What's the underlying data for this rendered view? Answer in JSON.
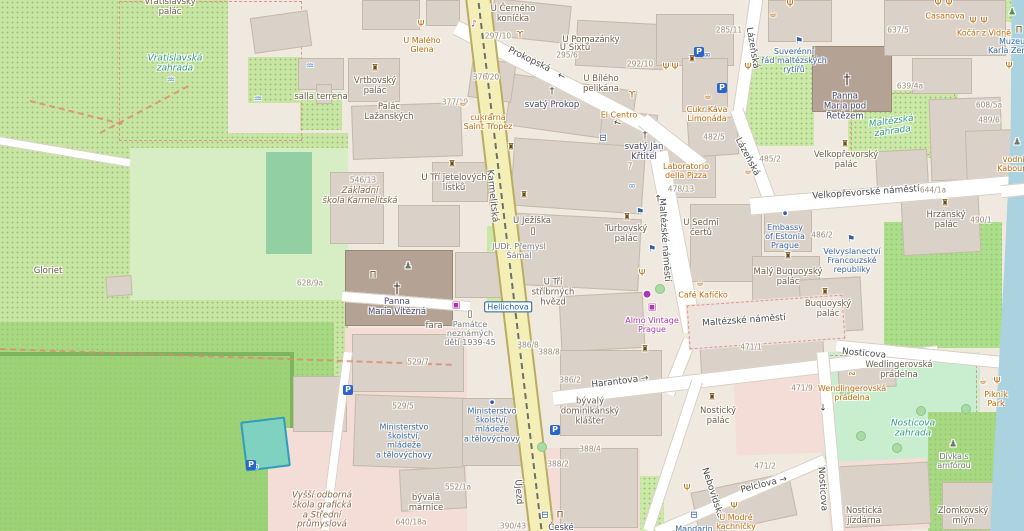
{
  "palette": {
    "road_main_yellow": "#f4efb7",
    "water_blue": "#aad3df",
    "park_green": "#c9e5a3",
    "bright_green": "#a6d980",
    "garden_green": "#cbe8a6",
    "mint_green": "#c8eecf",
    "building_gray": "#dad1c8",
    "church_brown": "#b4a294",
    "pink_area": "#f4dcd7",
    "pitch_teal": "#7fd2c0",
    "poi_orange": "#bf6c0a",
    "amenity_blue": "#3a68a0",
    "shop_purple": "#ac39ac",
    "church_label": "#464a6e",
    "garden_label": "#2f9e81",
    "street_label": "#4e4e4e",
    "house_number": "#9c8c79"
  },
  "labels": [
    {
      "t": "Prokopská",
      "x": 529,
      "y": 60,
      "k": "street",
      "r": 26
    },
    {
      "t": "Karmelitská",
      "x": 492,
      "y": 196,
      "k": "street",
      "r": 84
    },
    {
      "t": "Újezd",
      "x": 518,
      "y": 492,
      "k": "street",
      "r": 86
    },
    {
      "t": "Lázeňská",
      "x": 752,
      "y": 48,
      "k": "street",
      "r": 80
    },
    {
      "t": "Lázeňská",
      "x": 747,
      "y": 157,
      "k": "street",
      "r": 62
    },
    {
      "t": "Velkopřevorské náměstí",
      "x": 866,
      "y": 193,
      "k": "street",
      "r": -4
    },
    {
      "t": "Maltézské náměstí",
      "x": 664,
      "y": 240,
      "k": "street",
      "r": 86
    },
    {
      "t": "Maltézské náměstí",
      "x": 744,
      "y": 321,
      "k": "street",
      "r": -4
    },
    {
      "t": "Harantova →",
      "x": 620,
      "y": 382,
      "k": "street",
      "r": -7
    },
    {
      "t": "Nosticova",
      "x": 864,
      "y": 354,
      "k": "street",
      "r": 5
    },
    {
      "t": "Nosticova",
      "x": 822,
      "y": 489,
      "k": "street",
      "r": 86
    },
    {
      "t": "Pelclova →",
      "x": 764,
      "y": 485,
      "k": "street",
      "r": -14
    },
    {
      "t": "Nebovidská",
      "x": 712,
      "y": 493,
      "k": "street",
      "r": 72
    },
    {
      "t": "Hellichova",
      "x": 508,
      "y": 307,
      "k": "stop"
    },
    {
      "t": "546/13",
      "x": 363,
      "y": 181,
      "k": "house"
    },
    {
      "t": "628/9a",
      "x": 310,
      "y": 284,
      "k": "house"
    },
    {
      "t": "529/7",
      "x": 418,
      "y": 363,
      "k": "house"
    },
    {
      "t": "529/5",
      "x": 403,
      "y": 407,
      "k": "house"
    },
    {
      "t": "552/1a",
      "x": 458,
      "y": 488,
      "k": "house"
    },
    {
      "t": "640/18a",
      "x": 411,
      "y": 523,
      "k": "house"
    },
    {
      "t": "390/43",
      "x": 513,
      "y": 527,
      "k": "house"
    },
    {
      "t": "386/2",
      "x": 570,
      "y": 381,
      "k": "house"
    },
    {
      "t": "386/8",
      "x": 528,
      "y": 346,
      "k": "house"
    },
    {
      "t": "388/8",
      "x": 549,
      "y": 353,
      "k": "house"
    },
    {
      "t": "388/2",
      "x": 558,
      "y": 465,
      "k": "house"
    },
    {
      "t": "388/4",
      "x": 590,
      "y": 450,
      "k": "house"
    },
    {
      "t": "377/19",
      "x": 455,
      "y": 103,
      "k": "house"
    },
    {
      "t": "376/20",
      "x": 486,
      "y": 78,
      "k": "house"
    },
    {
      "t": "297/10",
      "x": 498,
      "y": 37,
      "k": "house"
    },
    {
      "t": "295/6",
      "x": 567,
      "y": 56,
      "k": "house"
    },
    {
      "t": "292/10",
      "x": 640,
      "y": 65,
      "k": "house"
    },
    {
      "t": "285/11",
      "x": 729,
      "y": 31,
      "k": "house"
    },
    {
      "t": "482/5",
      "x": 714,
      "y": 138,
      "k": "house"
    },
    {
      "t": "485/2",
      "x": 770,
      "y": 160,
      "k": "house"
    },
    {
      "t": "478/13",
      "x": 681,
      "y": 190,
      "k": "house"
    },
    {
      "t": "471/1",
      "x": 751,
      "y": 348,
      "k": "house"
    },
    {
      "t": "471/9",
      "x": 802,
      "y": 389,
      "k": "house"
    },
    {
      "t": "471/2",
      "x": 765,
      "y": 467,
      "k": "house"
    },
    {
      "t": "486/2",
      "x": 822,
      "y": 236,
      "k": "house"
    },
    {
      "t": "490/1",
      "x": 981,
      "y": 221,
      "k": "house"
    },
    {
      "t": "644/1a",
      "x": 933,
      "y": 191,
      "k": "house"
    },
    {
      "t": "637/5",
      "x": 898,
      "y": 31,
      "k": "house"
    },
    {
      "t": "639/4a",
      "x": 910,
      "y": 87,
      "k": "house"
    },
    {
      "t": "608/5a",
      "x": 989,
      "y": 106,
      "k": "house"
    },
    {
      "t": "489/6",
      "x": 989,
      "y": 121,
      "k": "house"
    },
    {
      "t": "7",
      "x": 630,
      "y": 167,
      "k": "house"
    },
    {
      "t": "U Malého\nGlena",
      "x": 422,
      "y": 45,
      "k": "poi"
    },
    {
      "t": "cukrárna\nSaint Tropez",
      "x": 488,
      "y": 122,
      "k": "poi"
    },
    {
      "t": "El Centro",
      "x": 619,
      "y": 115,
      "k": "poi"
    },
    {
      "t": "Cukr Káva\nLimonáda",
      "x": 707,
      "y": 114,
      "k": "poi"
    },
    {
      "t": "Laboratorio\ndella Pizza",
      "x": 686,
      "y": 171,
      "k": "poi"
    },
    {
      "t": "Café Kafíčko",
      "x": 703,
      "y": 295,
      "k": "poi"
    },
    {
      "t": "Casanova",
      "x": 945,
      "y": 16,
      "k": "poi"
    },
    {
      "t": "Kočár z Vidně",
      "x": 984,
      "y": 33,
      "k": "poi"
    },
    {
      "t": "vodník\nKabourek",
      "x": 1016,
      "y": 164,
      "k": "poi"
    },
    {
      "t": "Wendlingerovská\nprádelna",
      "x": 852,
      "y": 393,
      "k": "poi"
    },
    {
      "t": "Piknik\nPark",
      "x": 996,
      "y": 399,
      "k": "poi"
    },
    {
      "t": "U Modré\nkachničky",
      "x": 736,
      "y": 522,
      "k": "poi"
    },
    {
      "t": "Almo Vintage\nPrague",
      "x": 652,
      "y": 325,
      "k": "shop"
    },
    {
      "t": "Suverénní\nřád maltézských\nrytířů",
      "x": 794,
      "y": 61,
      "k": "blue"
    },
    {
      "t": "Embassy\nof Estonia\nPrague",
      "x": 785,
      "y": 237,
      "k": "blue"
    },
    {
      "t": "Velvyslanectví\nFrancouzské\nrepubliky",
      "x": 852,
      "y": 261,
      "k": "blue"
    },
    {
      "t": "Ministerstvo\nškolství,\nmládeže\na tělovýchovy",
      "x": 404,
      "y": 441,
      "k": "blue"
    },
    {
      "t": "Ministerstvo\nškolství,\nmládeže\na tělovýchovy",
      "x": 492,
      "y": 425,
      "k": "blue"
    },
    {
      "t": "Muzeum\nKarla Zemana",
      "x": 1016,
      "y": 46,
      "k": "blue"
    },
    {
      "t": "Mandarin",
      "x": 694,
      "y": 529,
      "k": "blue"
    },
    {
      "t": "svatý Prokop",
      "x": 552,
      "y": 106,
      "k": "church"
    },
    {
      "t": "svatý Jan\nKřtitel",
      "x": 644,
      "y": 153,
      "k": "church"
    },
    {
      "t": "Panna\nMaria pod\nŘetězem",
      "x": 845,
      "y": 107,
      "k": "church"
    },
    {
      "t": "Panna\nMaria Vítězná",
      "x": 397,
      "y": 308,
      "k": "church"
    },
    {
      "t": "České",
      "x": 561,
      "y": 529,
      "k": "church"
    },
    {
      "t": "U Černého\nkoníčka",
      "x": 513,
      "y": 15,
      "k": "bldg"
    },
    {
      "t": "U Pomazánky",
      "x": 591,
      "y": 41,
      "k": "bldg"
    },
    {
      "t": "U Sixtů",
      "x": 575,
      "y": 49,
      "k": "bldg"
    },
    {
      "t": "U Bílého\npelikána",
      "x": 601,
      "y": 85,
      "k": "bldg"
    },
    {
      "t": "Vrtbovský\npalác",
      "x": 375,
      "y": 87,
      "k": "bldg"
    },
    {
      "t": "Palác\nLažanských",
      "x": 389,
      "y": 113,
      "k": "bldg"
    },
    {
      "t": "U Tří jetelových\nlístků",
      "x": 454,
      "y": 184,
      "k": "bldg"
    },
    {
      "t": "U Ježíška",
      "x": 532,
      "y": 222,
      "k": "bldg"
    },
    {
      "t": "U Tří\nstříbrných\nhvězd",
      "x": 553,
      "y": 293,
      "k": "bldg"
    },
    {
      "t": "Turbovský\npalác",
      "x": 626,
      "y": 235,
      "k": "bldg"
    },
    {
      "t": "U Sedmi\nčertů",
      "x": 701,
      "y": 229,
      "k": "bldg"
    },
    {
      "t": "Malý Buquoyský\npalác",
      "x": 788,
      "y": 278,
      "k": "bldg"
    },
    {
      "t": "Buquoyský\npalác",
      "x": 828,
      "y": 310,
      "k": "bldg"
    },
    {
      "t": "Hrzánský\npalác",
      "x": 946,
      "y": 221,
      "k": "bldg"
    },
    {
      "t": "Velkopřevorský\npalác",
      "x": 846,
      "y": 161,
      "k": "bldg"
    },
    {
      "t": "Nostický\npalác",
      "x": 718,
      "y": 417,
      "k": "bldg"
    },
    {
      "t": "bývalý\ndominikánský\nklášter",
      "x": 590,
      "y": 412,
      "k": "bldg"
    },
    {
      "t": "bývalá\nmárnice",
      "x": 426,
      "y": 504,
      "k": "bldg"
    },
    {
      "t": "Wedlingerovská\nprádelna",
      "x": 899,
      "y": 371,
      "k": "bldg"
    },
    {
      "t": "Nostická\njízdárna",
      "x": 864,
      "y": 517,
      "k": "bldg"
    },
    {
      "t": "Zlomkovský\nmlýn",
      "x": 963,
      "y": 517,
      "k": "bldg"
    },
    {
      "t": "salla terrena",
      "x": 321,
      "y": 98,
      "k": "bldg"
    },
    {
      "t": "Gloriet",
      "x": 48,
      "y": 272,
      "k": "bldg"
    },
    {
      "t": "fara",
      "x": 434,
      "y": 327,
      "k": "bldg"
    },
    {
      "t": "Vratislavský\npalác",
      "x": 170,
      "y": 8,
      "k": "bldg"
    },
    {
      "t": "JUDr. Přemysl\nŠámal",
      "x": 519,
      "y": 251,
      "k": "gray"
    },
    {
      "t": "Památce\nneznámých\ndětí 1939-45",
      "x": 470,
      "y": 334,
      "k": "gray"
    },
    {
      "t": "Dívka s\namfórou",
      "x": 954,
      "y": 461,
      "k": "gray"
    },
    {
      "t": "Vratislavská\nzahrada",
      "x": 175,
      "y": 64,
      "k": "garden"
    },
    {
      "t": "Maltézská\nzahrada",
      "x": 892,
      "y": 127,
      "k": "garden",
      "r": -8
    },
    {
      "t": "Nosticova\nzahrada",
      "x": 913,
      "y": 429,
      "k": "garden"
    },
    {
      "t": "Základní\nškola Karmelitská",
      "x": 360,
      "y": 197,
      "k": "school"
    },
    {
      "t": "Vyšší odborná\nškola grafická\na Střední\nprůmyslová",
      "x": 322,
      "y": 511,
      "k": "school"
    }
  ],
  "icons": [
    {
      "n": "fountain-icon",
      "g": "♒",
      "x": 171,
      "y": 81,
      "c": "ltblue"
    },
    {
      "n": "fountain-icon",
      "g": "♒",
      "x": 310,
      "y": 67,
      "c": "ltblue"
    },
    {
      "n": "fountain-icon",
      "g": "♒",
      "x": 258,
      "y": 100,
      "c": "ltblue"
    },
    {
      "n": "church-cross-icon",
      "g": "†",
      "x": 397,
      "y": 289,
      "c": "dark",
      "s": 14
    },
    {
      "n": "church-cross-icon",
      "g": "†",
      "x": 847,
      "y": 80,
      "c": "dark",
      "s": 14
    },
    {
      "n": "church-cross-icon",
      "g": "†",
      "x": 552,
      "y": 92,
      "c": "dark",
      "s": 10
    },
    {
      "n": "church-cross-icon",
      "g": "†",
      "x": 645,
      "y": 136,
      "c": "dark",
      "s": 10
    },
    {
      "n": "castle-icon",
      "g": "♜",
      "x": 375,
      "y": 69,
      "c": "brown"
    },
    {
      "n": "castle-icon",
      "g": "♜",
      "x": 452,
      "y": 165,
      "c": "brown"
    },
    {
      "n": "castle-icon",
      "g": "♜",
      "x": 511,
      "y": 148,
      "c": "brown"
    },
    {
      "n": "castle-icon",
      "g": "♜",
      "x": 524,
      "y": 196,
      "c": "brown"
    },
    {
      "n": "castle-icon",
      "g": "♜",
      "x": 627,
      "y": 218,
      "c": "brown"
    },
    {
      "n": "castle-icon",
      "g": "♜",
      "x": 788,
      "y": 257,
      "c": "brown"
    },
    {
      "n": "castle-icon",
      "g": "♜",
      "x": 825,
      "y": 293,
      "c": "brown"
    },
    {
      "n": "castle-icon",
      "g": "♜",
      "x": 945,
      "y": 204,
      "c": "brown"
    },
    {
      "n": "castle-icon",
      "g": "♜",
      "x": 845,
      "y": 145,
      "c": "brown"
    },
    {
      "n": "castle-icon",
      "g": "♜",
      "x": 712,
      "y": 398,
      "c": "brown"
    },
    {
      "n": "castle-icon",
      "g": "♜",
      "x": 692,
      "y": 60,
      "c": "brown"
    },
    {
      "n": "castle-icon",
      "g": "♜",
      "x": 645,
      "y": 350,
      "c": "brown"
    },
    {
      "n": "flag-icon",
      "g": "⚑",
      "x": 799,
      "y": 42,
      "c": "blue"
    },
    {
      "n": "flag-icon",
      "g": "⚑",
      "x": 851,
      "y": 240,
      "c": "blue"
    },
    {
      "n": "flag-icon",
      "g": "⚑",
      "x": 640,
      "y": 213,
      "c": "blue"
    },
    {
      "n": "flag-icon",
      "g": "⚑",
      "x": 652,
      "y": 250,
      "c": "blue"
    },
    {
      "n": "cafe-icon",
      "g": "☕",
      "x": 463,
      "y": 104,
      "c": "orange"
    },
    {
      "n": "cafe-icon",
      "g": "☕",
      "x": 708,
      "y": 97,
      "c": "orange"
    },
    {
      "n": "cafe-icon",
      "g": "☕",
      "x": 700,
      "y": 284,
      "c": "orange"
    },
    {
      "n": "cafe-icon",
      "g": "☕",
      "x": 773,
      "y": 15,
      "c": "orange"
    },
    {
      "n": "cafe-icon",
      "g": "☕",
      "x": 748,
      "y": 172,
      "c": "orange"
    },
    {
      "n": "cafe-icon",
      "g": "☕",
      "x": 983,
      "y": 382,
      "c": "orange"
    },
    {
      "n": "restaurant-icon",
      "g": "Ψ",
      "x": 421,
      "y": 25,
      "c": "orange"
    },
    {
      "n": "restaurant-icon",
      "g": "Ψ",
      "x": 938,
      "y": 4,
      "c": "orange"
    },
    {
      "n": "restaurant-icon",
      "g": "Ψ",
      "x": 949,
      "y": 4,
      "c": "orange"
    },
    {
      "n": "restaurant-icon",
      "g": "Ψ",
      "x": 973,
      "y": 22,
      "c": "orange"
    },
    {
      "n": "restaurant-icon",
      "g": "Ψ",
      "x": 984,
      "y": 22,
      "c": "orange"
    },
    {
      "n": "restaurant-icon",
      "g": "Ψ",
      "x": 666,
      "y": 68,
      "c": "orange"
    },
    {
      "n": "restaurant-icon",
      "g": "Ψ",
      "x": 675,
      "y": 68,
      "c": "orange"
    },
    {
      "n": "restaurant-icon",
      "g": "Ψ",
      "x": 748,
      "y": 68,
      "c": "orange"
    },
    {
      "n": "restaurant-icon",
      "g": "Ψ",
      "x": 790,
      "y": 5,
      "c": "orange"
    },
    {
      "n": "restaurant-icon",
      "g": "Ψ",
      "x": 642,
      "y": 274,
      "c": "orange"
    },
    {
      "n": "restaurant-icon",
      "g": "Ψ",
      "x": 734,
      "y": 507,
      "c": "orange"
    },
    {
      "n": "restaurant-icon",
      "g": "Ψ",
      "x": 687,
      "y": 489,
      "c": "orange"
    },
    {
      "n": "restaurant-icon",
      "g": "Ψ",
      "x": 997,
      "y": 382,
      "c": "orange"
    },
    {
      "n": "restaurant-icon",
      "g": "Ψ",
      "x": 1009,
      "y": 67,
      "c": "orange"
    },
    {
      "n": "bar-icon",
      "g": "ϒ",
      "x": 520,
      "y": 36,
      "c": "orange"
    },
    {
      "n": "bar-icon",
      "g": "ϒ",
      "x": 632,
      "y": 96,
      "c": "orange"
    },
    {
      "n": "museum-icon",
      "g": "Π",
      "x": 373,
      "y": 276,
      "c": "brown"
    },
    {
      "n": "museum-icon",
      "g": "Π",
      "x": 560,
      "y": 516,
      "c": "brown"
    },
    {
      "n": "museum-icon",
      "g": "Π",
      "x": 1019,
      "y": 31,
      "c": "brown"
    },
    {
      "n": "statue-icon",
      "g": "♟",
      "x": 408,
      "y": 267,
      "c": "gray"
    },
    {
      "n": "statue-icon",
      "g": "♟",
      "x": 953,
      "y": 445,
      "c": "gray"
    },
    {
      "n": "statue-icon",
      "g": "♟",
      "x": 1017,
      "y": 143,
      "c": "gray"
    },
    {
      "n": "statue-icon",
      "g": "♟",
      "x": 1012,
      "y": 13,
      "c": "green"
    },
    {
      "n": "memorial-icon",
      "g": "▯",
      "x": 533,
      "y": 232,
      "c": "dark"
    },
    {
      "n": "memorial-icon",
      "g": "▯",
      "x": 470,
      "y": 315,
      "c": "dark"
    },
    {
      "n": "hotel-icon",
      "g": "⊟",
      "x": 603,
      "y": 139,
      "c": "blue"
    },
    {
      "n": "hotel-icon",
      "g": "⊟",
      "x": 694,
      "y": 516,
      "c": "blue"
    },
    {
      "n": "hotel-icon",
      "g": "⊟",
      "x": 545,
      "y": 516,
      "c": "blue"
    },
    {
      "n": "bicycle-icon",
      "g": "∞",
      "x": 707,
      "y": 56,
      "c": "blue"
    },
    {
      "n": "bicycle-icon",
      "g": "∞",
      "x": 632,
      "y": 187,
      "c": "ltblue"
    },
    {
      "n": "bicycle-icon",
      "g": "∞",
      "x": 255,
      "y": 468,
      "c": "blue"
    },
    {
      "n": "office-dot-icon",
      "g": "●",
      "x": 492,
      "y": 403,
      "c": "blue",
      "s": 5
    },
    {
      "n": "office-dot-icon",
      "g": "●",
      "x": 785,
      "y": 214,
      "c": "blue",
      "s": 5
    },
    {
      "n": "shop-icon",
      "g": "●",
      "x": 647,
      "y": 295,
      "c": "purple"
    },
    {
      "n": "shop-icon",
      "g": "▣",
      "x": 652,
      "y": 308,
      "c": "purple"
    },
    {
      "n": "shop-icon",
      "g": "▣",
      "x": 456,
      "y": 306,
      "c": "purple"
    },
    {
      "n": "music-venue-icon",
      "g": "♪",
      "x": 474,
      "y": 25,
      "c": "purple"
    },
    {
      "n": "bakery-icon",
      "g": "∾",
      "x": 852,
      "y": 375,
      "c": "orange"
    },
    {
      "n": "oneway-arrow-icon",
      "g": "←",
      "x": 561,
      "y": 77,
      "c": "dark",
      "r": 26
    },
    {
      "n": "oneway-arrow-icon",
      "g": "←",
      "x": 617,
      "y": 124,
      "c": "dark",
      "r": 20
    },
    {
      "n": "oneway-arrow-icon",
      "g": "↑",
      "x": 658,
      "y": 200,
      "c": "dark"
    },
    {
      "n": "oneway-arrow-icon",
      "g": "↓",
      "x": 823,
      "y": 409,
      "c": "dark"
    },
    {
      "n": "parking-icon",
      "g": "P",
      "x": 699,
      "y": 52
    },
    {
      "n": "parking-icon",
      "g": "P",
      "x": 722,
      "y": 88
    },
    {
      "n": "parking-icon",
      "g": "P",
      "x": 348,
      "y": 390
    },
    {
      "n": "parking-icon",
      "g": "P",
      "x": 555,
      "y": 430
    },
    {
      "n": "parking-icon",
      "g": "P",
      "x": 251,
      "y": 465
    }
  ]
}
